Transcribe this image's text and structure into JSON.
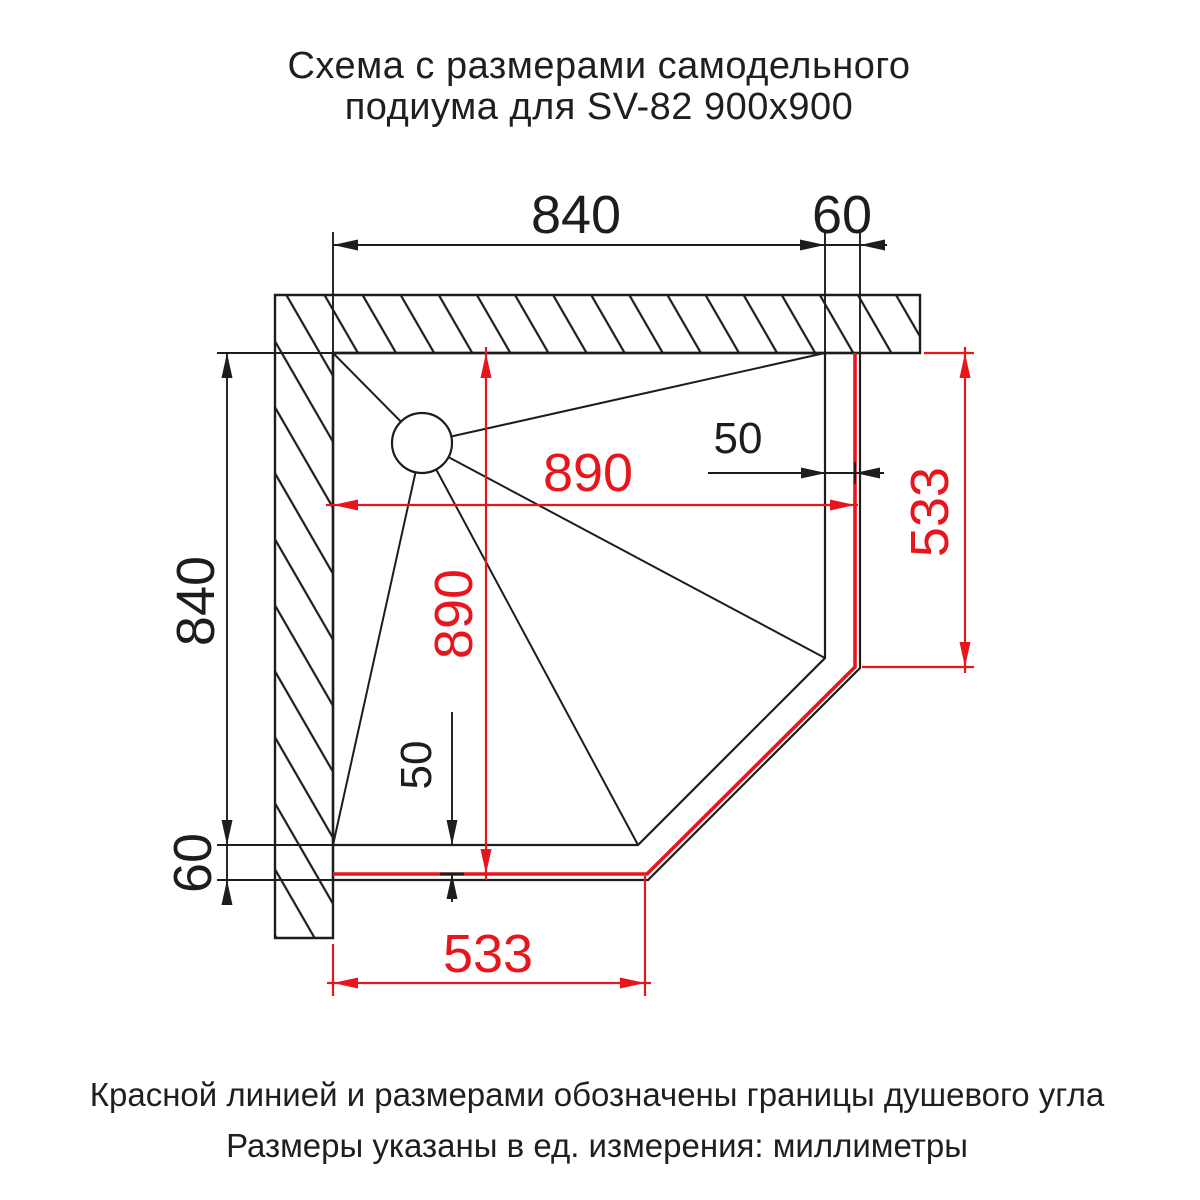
{
  "title": {
    "line1": "Схема с размерами самодельного",
    "line2": "подиума для SV-82 900х900"
  },
  "footnotes": {
    "line1": "Красной линией и размерами обозначены границы душевого угла",
    "line2": "Размеры указаны в ед. измерения: миллиметры"
  },
  "colors": {
    "drawing_black": "#1d1d1b",
    "shower_boundary_red": "#e8151d",
    "background": "#ffffff"
  },
  "dimensions": {
    "black": {
      "top_width": "840",
      "top_wall_offset": "60",
      "left_height": "840",
      "left_wall_offset": "60",
      "right_gap": "50",
      "bottom_gap": "50"
    },
    "red": {
      "shower_width": "890",
      "shower_depth": "890",
      "right_straight_side": "533",
      "bottom_straight_side": "533"
    }
  }
}
